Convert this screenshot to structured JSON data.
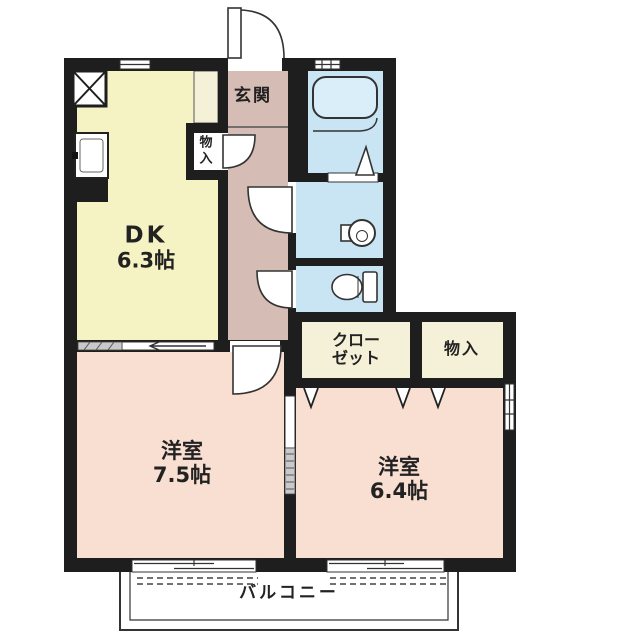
{
  "plan_type": "apartment-floor-plan",
  "colors": {
    "wall": "#1e1e1e",
    "dk_fill": "#f5f2c3",
    "hall_fill": "#d5bcb5",
    "wet_fill": "#c9e5f4",
    "tub_fill": "#daeefa",
    "bedroom_fill": "#f9ded2",
    "closet_fill": "#f5f1d9",
    "outline": "#333333",
    "text": "#222222"
  },
  "rooms": {
    "dining_kitchen": {
      "name": "DK",
      "size": "6.3帖"
    },
    "entrance": {
      "name": "玄関"
    },
    "hall_storage": {
      "name": "物入",
      "chars": [
        "物",
        "入"
      ]
    },
    "closet": {
      "line1": "クロー",
      "line2": "ゼット"
    },
    "storage": {
      "name": "物入"
    },
    "bedroom_1": {
      "name": "洋室",
      "size": "7.5帖"
    },
    "bedroom_2": {
      "name": "洋室",
      "size": "6.4帖"
    },
    "balcony": {
      "name": "バルコニー"
    }
  },
  "icons": [
    "bathtub-icon",
    "washbasin-icon",
    "toilet-icon",
    "kitchen-sink-icon",
    "refrigerator-space-icon",
    "shower-triangle-icon",
    "door-swing-arc-icon",
    "folding-door-v-icon",
    "sliding-door-icon",
    "window-icon"
  ]
}
